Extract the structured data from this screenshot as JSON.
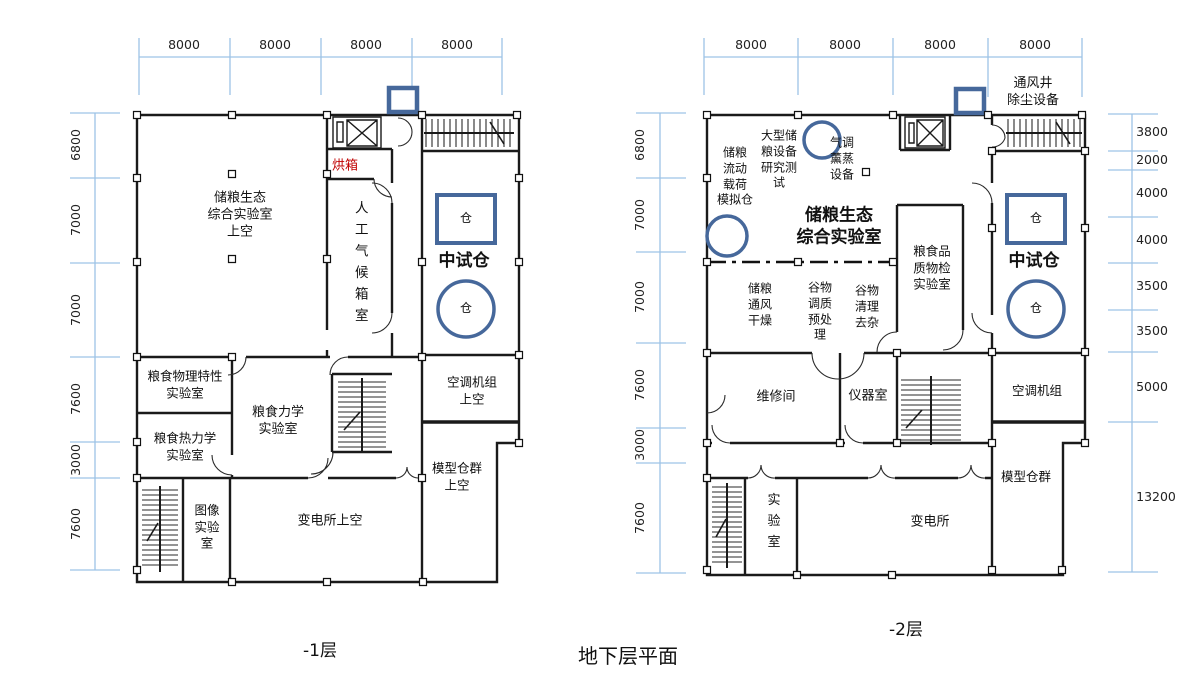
{
  "title": "地下层平面",
  "colors": {
    "dimension_line": "#9dc3e6",
    "bin_outline": "#46689b",
    "oven_text": "#c00000",
    "wall": "#1a1a1a"
  },
  "plan1": {
    "name": "-1层",
    "top_dims": [
      "8000",
      "8000",
      "8000",
      "8000"
    ],
    "left_dims": [
      "6800",
      "7000",
      "7000",
      "7600",
      "3000",
      "7600"
    ],
    "labels": {
      "eco_lab": "储粮生态\n综合实验室\n上空",
      "oven": "烘箱",
      "climate_chamber": "人工气候箱室",
      "pilot_bin": "中试仓",
      "bin_square": "仓",
      "bin_circle": "仓",
      "hvac": "空调机组\n上空",
      "model_bins": "模型仓群\n上空",
      "grain_physical": "粮食物理特性\n实验室",
      "grain_mechanics": "粮食力学\n实验室",
      "grain_thermo": "粮食热力学\n实验室",
      "image_lab": "图像\n实验\n室",
      "substation": "变电所上空"
    }
  },
  "plan2": {
    "name": "-2层",
    "top_dims": [
      "8000",
      "8000",
      "8000",
      "8000"
    ],
    "left_dims": [
      "6800",
      "7000",
      "7000",
      "7600",
      "3000",
      "7600"
    ],
    "right_dims": [
      "3800",
      "2000",
      "4000",
      "4000",
      "3500",
      "3500",
      "5000",
      "13200"
    ],
    "labels": {
      "vent_shaft": "通风井\n除尘设备",
      "flow_load": "储粮\n流动\n载荷\n模拟仓",
      "large_equipment": "大型储\n粮设备\n研究测\n试",
      "fumigation": "气调\n薰蒸\n设备",
      "eco_lab": "储粮生态\n综合实验室",
      "quality_lab": "粮食品\n质物检\n实验室",
      "drying": "储粮\n通风\n干燥",
      "conditioning": "谷物\n调质\n预处\n理",
      "cleaning": "谷物\n清理\n去杂",
      "repair_room": "维修间",
      "instrument_room": "仪器室",
      "pilot_bin": "中试仓",
      "bin_square": "仓",
      "bin_circle": "仓",
      "hvac": "空调机组",
      "model_bins": "模型仓群",
      "lab": "实验室",
      "substation": "变电所"
    }
  }
}
